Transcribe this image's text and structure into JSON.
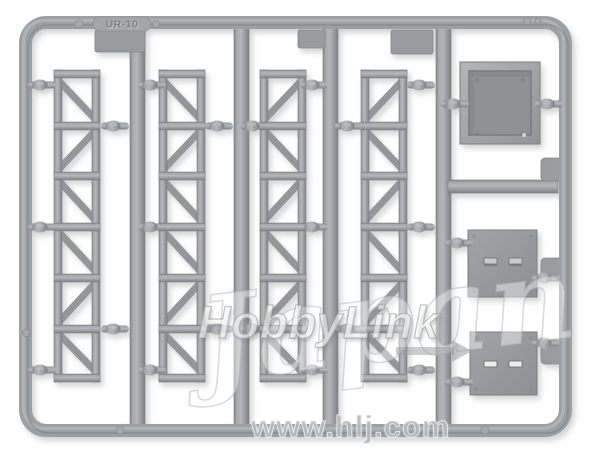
{
  "sprue": {
    "molded_code": "UR-10"
  },
  "watermark": {
    "brand": "HobbyLink",
    "script": "Japan",
    "url": "www.hlj.com"
  },
  "colors": {
    "background": "#ffffff",
    "plastic": "#9da0a3",
    "plastic_light": "#b7b9bc",
    "plastic_dark": "#7d7f83",
    "recess": "#8f9194",
    "watermark_gray": "#c6c8ca"
  }
}
